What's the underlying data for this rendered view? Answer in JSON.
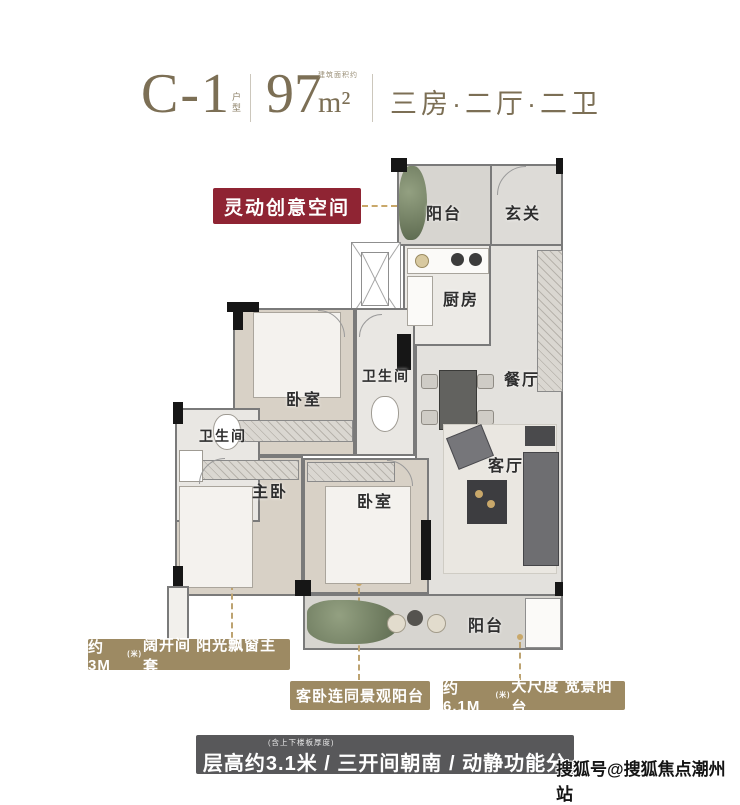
{
  "header": {
    "unit_code": "C-1",
    "unit_tag": "户型",
    "area_number": "97",
    "area_unit": "m²",
    "area_note": "建筑面积约",
    "layout_text": "三房·二厅·二卫"
  },
  "callout": {
    "creative_space": "灵动创意空间"
  },
  "rooms": {
    "balcony_top": "阳台",
    "foyer": "玄关",
    "kitchen": "厨房",
    "dining": "餐厅",
    "bedroom_top": "卧室",
    "bath_mid": "卫生间",
    "bath_left": "卫生间",
    "master_bedroom": "主卧",
    "bedroom_mid": "卧室",
    "living": "客厅",
    "balcony_bottom": "阳台"
  },
  "features": {
    "master_prefix": "约3M",
    "master_sub": "(米)",
    "master_text": "阔开间 阳光飘窗主套",
    "guest_balcony": "客卧连同景观阳台",
    "wide_prefix": "约6.1M",
    "wide_sub": "(米)",
    "wide_text": "大尺度 宽景阳台"
  },
  "banner": {
    "note": "(含上下楼板厚度)",
    "text": "层高约3.1米 / 三开间朝南 / 动静功能分区"
  },
  "watermark": "搜狐号@搜狐焦点潮州站",
  "colors": {
    "accent_bronze": "#7c6f55",
    "label_gold": "#9d8a63",
    "callout_red": "#8f2433",
    "banner_gray": "#58585a",
    "leader_gold": "#c9a86a"
  }
}
